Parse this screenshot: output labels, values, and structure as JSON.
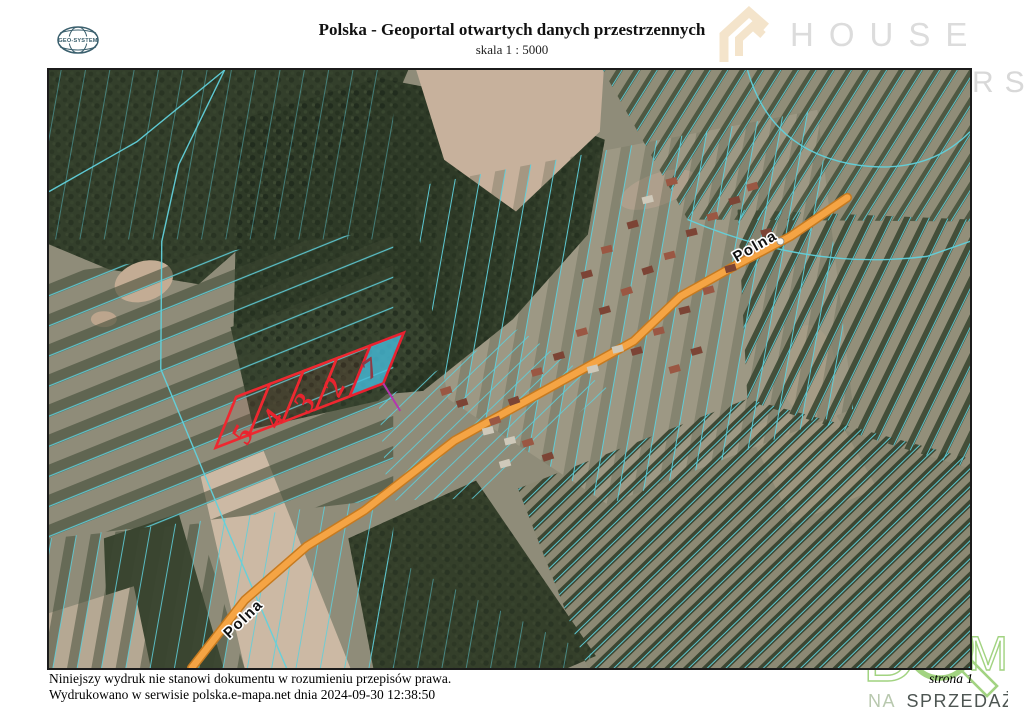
{
  "header": {
    "logo_text": "GEO-SYSTEM",
    "title": "Polska - Geoportal otwartych danych przestrzennych",
    "scale": "skala 1 : 5000"
  },
  "watermark": {
    "word": "HOUSE",
    "partial_second_word": "RS"
  },
  "map": {
    "road_labels": [
      {
        "text": "Polna"
      },
      {
        "text": "Polna"
      }
    ],
    "parcels": {
      "numbers": [
        "5",
        "4",
        "3",
        "2",
        "7"
      ],
      "highlight_number": "7",
      "outline_color": "#ee2830",
      "highlight_fill": "#45bcd9",
      "number_color": "#e8242e",
      "highlight_number_color": "#8f3a45"
    },
    "colors": {
      "road": "#f5a444",
      "road_casing": "#c67a20",
      "cadastral_line": "#5ecfdb",
      "forest": "#2e3a27",
      "field": "#8f8c79"
    }
  },
  "footer": {
    "disclaimer": "Niniejszy wydruk nie stanowi dokumentu w rozumieniu przepisów prawa.",
    "printed": "Wydrukowano w serwisie polska.e-mapa.net dnia 2024-09-30 12:38:50",
    "page": "strona 1"
  },
  "brand": {
    "letter_d": "D",
    "letter_m": "M",
    "na": "NA",
    "sprzedaz": "SPRZEDAŻ"
  }
}
